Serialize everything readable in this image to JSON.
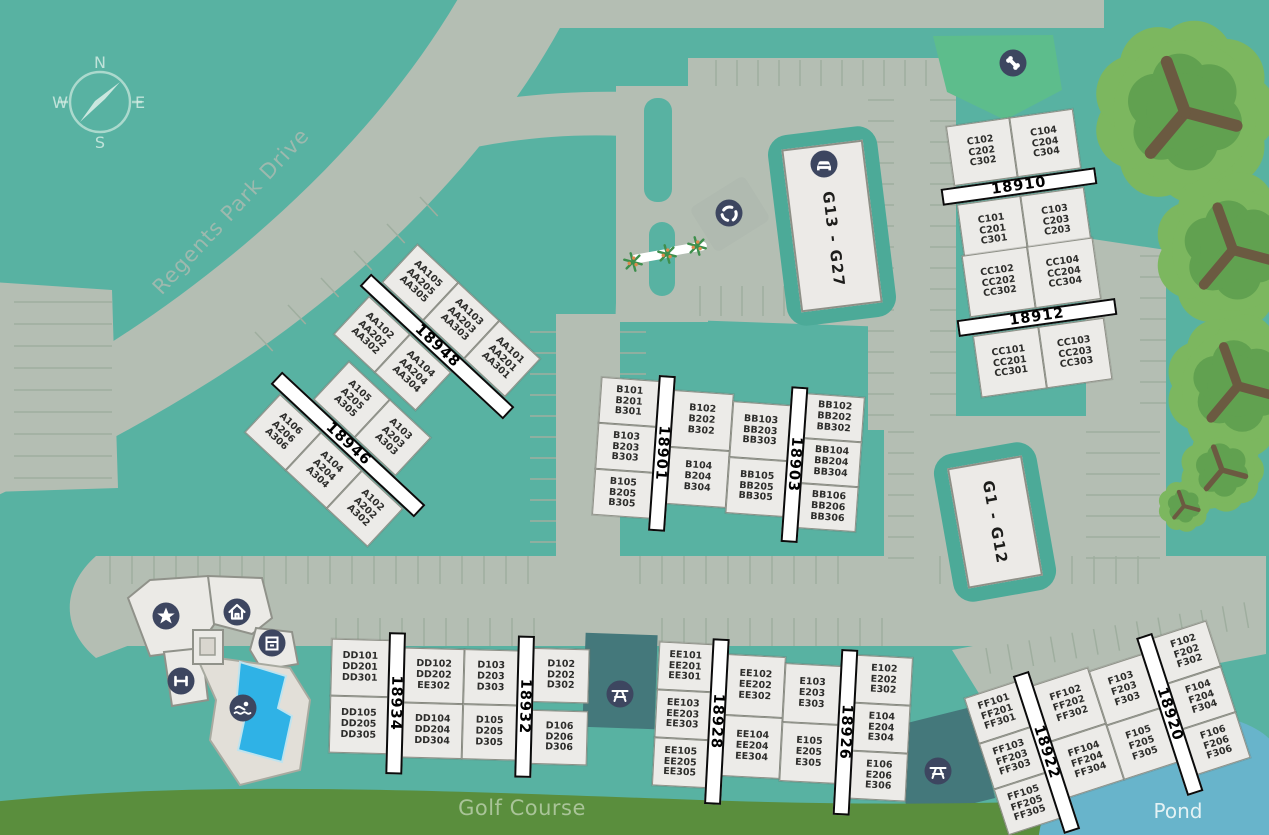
{
  "colors": {
    "terrain_teal": "#58b2a2",
    "road_gray": "#b4beb3",
    "parking_line": "#9fae9f",
    "building_fill": "#ecebe8",
    "building_border": "#8e9087",
    "banner_bg": "#ffffff",
    "banner_border": "#0b0b0b",
    "icon_circle_navy": "#3d4660",
    "garage_surround_teal": "#4caa98",
    "courtyard_teal": "#44787b",
    "dog_park_green": "#5dbd8c",
    "golf_green": "#5a8e3d",
    "pond_blue": "#68b4cb",
    "pool_blue": "#2fb2e6",
    "tree_green": "#7cb75f",
    "tree_inner_green": "#61a150",
    "tree_branch_brown": "#6b5a41"
  },
  "compass": {
    "north": "N",
    "east": "E",
    "south": "S",
    "west": "W"
  },
  "labels": {
    "street": "Regents Park Drive",
    "golf_course": "Golf Course",
    "pond": "Pond"
  },
  "garages": [
    {
      "id": "g13-g27",
      "label": "G13 - G27"
    },
    {
      "id": "g1-g12",
      "label": "G1 - G12"
    }
  ],
  "amenities": [
    {
      "name": "dog-park-bone-icon"
    },
    {
      "name": "garage-car-icon"
    },
    {
      "name": "recycle-icon"
    },
    {
      "name": "star-icon"
    },
    {
      "name": "home-icon"
    },
    {
      "name": "package-locker-icon"
    },
    {
      "name": "fitness-dumbbell-icon"
    },
    {
      "name": "pool-swimmer-icon"
    },
    {
      "name": "picnic-table-icon"
    },
    {
      "name": "picnic-table-icon"
    }
  ],
  "buildings": {
    "b18948": {
      "banner": "18948",
      "side_a": [
        [
          "AA105",
          "AA205",
          "AA305"
        ],
        [
          "AA103",
          "AA203",
          "AA303"
        ],
        [
          "AA101",
          "AA201",
          "AA301"
        ]
      ],
      "side_b": [
        [
          "AA102",
          "AA202",
          "AA302"
        ],
        [
          "AA104",
          "AA204",
          "AA304"
        ]
      ]
    },
    "b18946": {
      "banner": "18946",
      "side_a": [
        [
          "A105",
          "A205",
          "A305"
        ],
        [
          "A103",
          "A203",
          "A303"
        ]
      ],
      "side_b": [
        [
          "A106",
          "A206",
          "A306"
        ],
        [
          "A104",
          "A204",
          "A304"
        ],
        [
          "A102",
          "A202",
          "A302"
        ]
      ]
    },
    "b18901": {
      "banner": "18901",
      "side_a": [
        [
          "B101",
          "B201",
          "B301"
        ],
        [
          "B103",
          "B203",
          "B303"
        ],
        [
          "B105",
          "B205",
          "B305"
        ]
      ],
      "side_b": [
        [
          "B102",
          "B202",
          "B302"
        ],
        [
          "B104",
          "B204",
          "B304"
        ]
      ]
    },
    "b18903": {
      "banner": "18903",
      "side_a": [
        [
          "BB103",
          "BB203",
          "BB303"
        ],
        [
          "BB105",
          "BB205",
          "BB305"
        ]
      ],
      "side_b": [
        [
          "BB102",
          "BB202",
          "BB302"
        ],
        [
          "BB104",
          "BB204",
          "BB304"
        ],
        [
          "BB106",
          "BB206",
          "BB306"
        ]
      ]
    },
    "b18910": {
      "banner": "18910",
      "side_a": [
        [
          "C102",
          "C202",
          "C302"
        ],
        [
          "C104",
          "C204",
          "C304"
        ]
      ],
      "side_b": [
        [
          "C101",
          "C201",
          "C301"
        ],
        [
          "C103",
          "C203",
          "C203"
        ]
      ]
    },
    "b18912": {
      "banner": "18912",
      "side_a": [
        [
          "CC102",
          "CC202",
          "CC302"
        ],
        [
          "CC104",
          "CC204",
          "CC304"
        ]
      ],
      "side_b": [
        [
          "CC101",
          "CC201",
          "CC301"
        ],
        [
          "CC103",
          "CC203",
          "CC303"
        ]
      ]
    },
    "b18934": {
      "banner": "18934",
      "side_a": [
        [
          "DD101",
          "DD201",
          "DD301"
        ],
        [
          "DD105",
          "DD205",
          "DD305"
        ]
      ],
      "side_b": [
        [
          "DD102",
          "DD202",
          "EE302"
        ],
        [
          "DD104",
          "DD204",
          "DD304"
        ]
      ]
    },
    "b18932": {
      "banner": "18932",
      "side_a": [
        [
          "D103",
          "D203",
          "D303"
        ],
        [
          "D105",
          "D205",
          "D305"
        ]
      ],
      "side_b": [
        [
          "D102",
          "D202",
          "D302"
        ],
        [
          "D106",
          "D206",
          "D306"
        ]
      ]
    },
    "b18928": {
      "banner": "18928",
      "side_a": [
        [
          "EE101",
          "EE201",
          "EE301"
        ],
        [
          "EE103",
          "EE203",
          "EE303"
        ],
        [
          "EE105",
          "EE205",
          "EE305"
        ]
      ],
      "side_b": [
        [
          "EE102",
          "EE202",
          "EE302"
        ],
        [
          "EE104",
          "EE204",
          "EE304"
        ]
      ]
    },
    "b18926": {
      "banner": "18926",
      "side_a": [
        [
          "E103",
          "E203",
          "E303"
        ],
        [
          "E105",
          "E205",
          "E305"
        ]
      ],
      "side_b": [
        [
          "E102",
          "E202",
          "E302"
        ],
        [
          "E104",
          "E204",
          "E304"
        ],
        [
          "E106",
          "E206",
          "E306"
        ]
      ]
    },
    "b18922": {
      "banner": "18922",
      "side_a": [
        [
          "FF101",
          "FF201",
          "FF301"
        ],
        [
          "FF103",
          "FF203",
          "FF303"
        ],
        [
          "FF105",
          "FF205",
          "FF305"
        ]
      ],
      "side_b": [
        [
          "FF102",
          "FF202",
          "FF302"
        ],
        [
          "FF104",
          "FF204",
          "FF304"
        ]
      ]
    },
    "b18920": {
      "banner": "18920",
      "side_a": [
        [
          "F103",
          "F203",
          "F303"
        ],
        [
          "F105",
          "F205",
          "F305"
        ]
      ],
      "side_b": [
        [
          "F102",
          "F202",
          "F302"
        ],
        [
          "F104",
          "F204",
          "F304"
        ],
        [
          "F106",
          "F206",
          "F306"
        ]
      ]
    }
  }
}
